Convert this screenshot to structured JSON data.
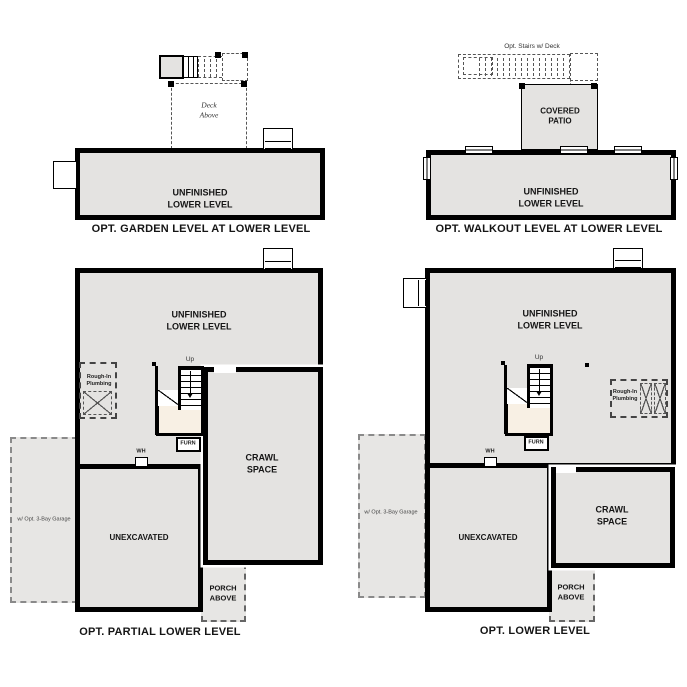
{
  "colors": {
    "background": "#ffffff",
    "wall": "#000000",
    "room_fill": "#e4e3e1",
    "landing_fill": "#f8f0e4",
    "dashed_line": "#666666"
  },
  "labels": {
    "unfinished_lower_level": "UNFINISHED\nLOWER LEVEL",
    "crawl_space": "CRAWL\nSPACE",
    "unexcavated": "UNEXCAVATED",
    "porch_above": "PORCH\nABOVE",
    "covered_patio": "COVERED\nPATIO",
    "deck_above": "Deck\nAbove",
    "opt_stairs_w_deck": "Opt. Stairs w/ Deck",
    "garage": "w/ Opt. 3-Bay Garage",
    "rough_in_plumbing": "Rough-In\nPlumbing",
    "furn": "FURN",
    "wh": "WH",
    "up": "Up"
  },
  "captions": {
    "garden": "OPT. GARDEN LEVEL AT LOWER LEVEL",
    "walkout": "OPT. WALKOUT LEVEL AT LOWER LEVEL",
    "partial": "OPT. PARTIAL LOWER LEVEL",
    "lower": "OPT. LOWER LEVEL"
  }
}
